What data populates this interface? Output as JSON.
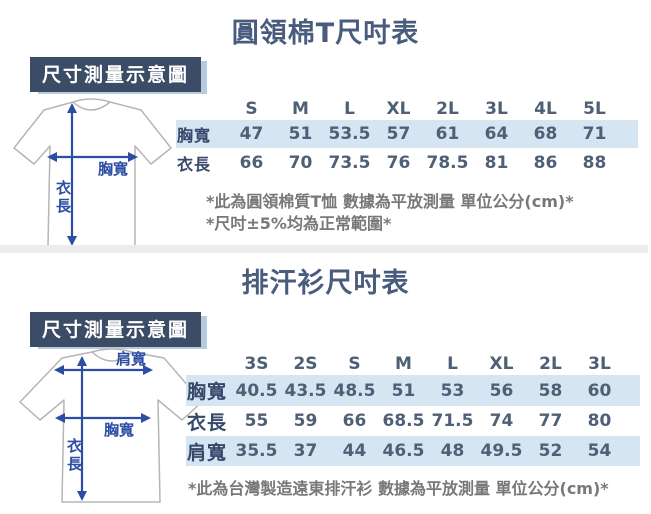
{
  "section1": {
    "title": "圓領棉T尺吋表",
    "diagram_label": "尺寸測量示意圖",
    "shirt_labels": {
      "chest": "胸寬",
      "length": "衣長"
    },
    "notes": [
      "*此為圓領棉質T恤 數據為平放測量 單位公分(cm)*",
      "*尺吋±5%均為正常範圍*"
    ]
  },
  "section2": {
    "title": "排汗衫尺吋表",
    "diagram_label": "尺寸測量示意圖",
    "shirt_labels": {
      "shoulder": "肩寬",
      "chest": "胸寬",
      "length": "衣長"
    },
    "notes": [
      "*此為台灣製造遠東排汗衫 數據為平放測量 單位公分(cm)*"
    ]
  },
  "chart_data": [
    {
      "type": "table",
      "title": "圓領棉T尺吋表",
      "unit": "公分(cm)",
      "columns": [
        "S",
        "M",
        "L",
        "XL",
        "2L",
        "3L",
        "4L",
        "5L"
      ],
      "rows": [
        {
          "label": "胸寬",
          "values": [
            47,
            51,
            53.5,
            57,
            61,
            64,
            68,
            71
          ]
        },
        {
          "label": "衣長",
          "values": [
            66,
            70,
            73.5,
            76,
            78.5,
            81,
            86,
            88
          ]
        }
      ]
    },
    {
      "type": "table",
      "title": "排汗衫尺吋表",
      "unit": "公分(cm)",
      "columns": [
        "3S",
        "2S",
        "S",
        "M",
        "L",
        "XL",
        "2L",
        "3L"
      ],
      "rows": [
        {
          "label": "胸寬",
          "values": [
            40.5,
            43.5,
            48.5,
            51,
            53,
            56,
            58,
            60
          ]
        },
        {
          "label": "衣長",
          "values": [
            55,
            59,
            66,
            68.5,
            71.5,
            74,
            77,
            80
          ]
        },
        {
          "label": "肩寬",
          "values": [
            35.5,
            37,
            44,
            46.5,
            48,
            49.5,
            52,
            54
          ]
        }
      ]
    }
  ],
  "colors": {
    "title_text": "#4a5c7e",
    "row_band": "#d5e5f2",
    "tag_background": "#3a4c66",
    "tag_shadow": "#b7cbdf",
    "arrow_blue": "#2c4da4",
    "note_text": "#787878",
    "value_text": "#4e6076"
  }
}
